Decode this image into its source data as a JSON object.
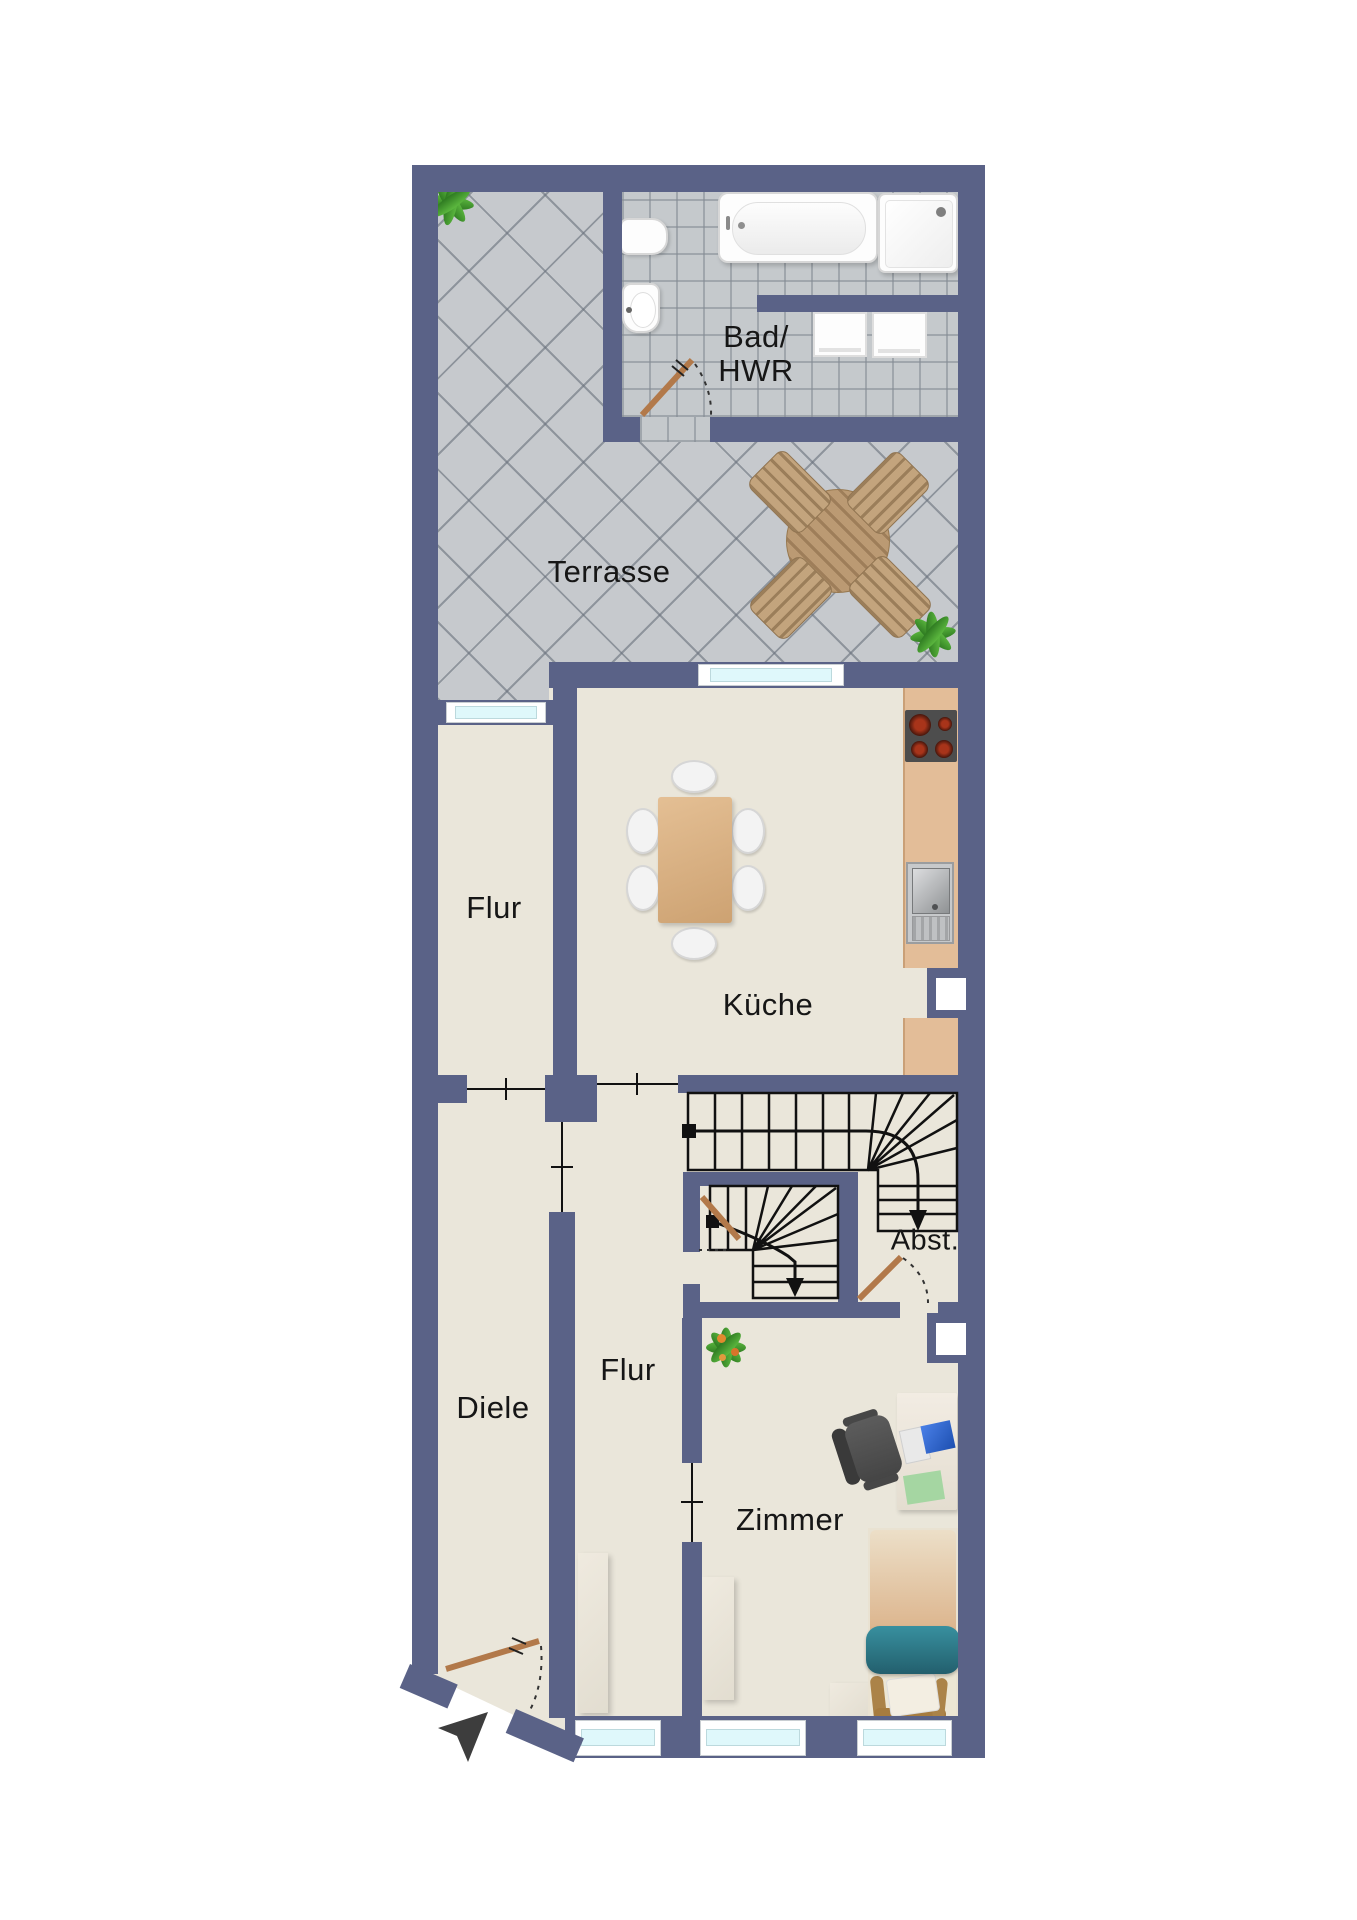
{
  "labels": {
    "bad": "Bad/",
    "hwr": "HWR",
    "terrasse": "Terrasse",
    "flur_upper": "Flur",
    "kueche": "Küche",
    "diele": "Diele",
    "flur_lower": "Flur",
    "zimmer": "Zimmer",
    "abst": "Abst."
  },
  "palette": {
    "wall": "#5a6287",
    "floor": "#eae6da",
    "terrace_tile": "#c6c9cd",
    "bath_tile": "#c5c9cc",
    "window_glass": "#dff8fb",
    "kitchen_counter": "#e3bd98",
    "table_wood": "#d8b083",
    "door_leaf": "#b2794a",
    "stair_line": "#111111",
    "label_text": "#161616",
    "bed_blanket_teal": "#2e7d8c",
    "plant_green": "#4aa233",
    "entrance_arrow": "#3d3d3d"
  }
}
